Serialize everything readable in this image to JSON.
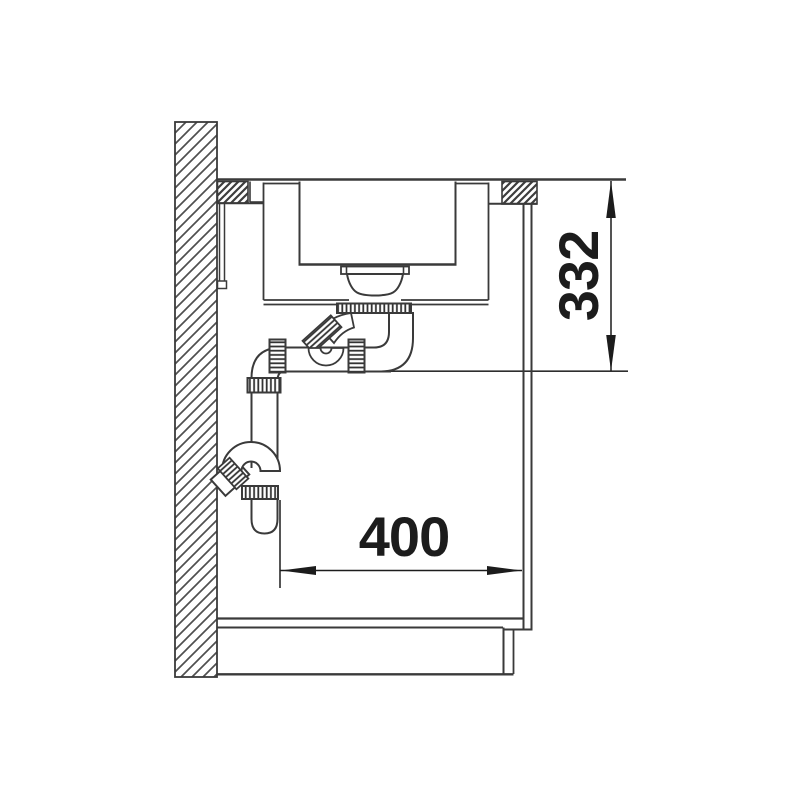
{
  "drawing": {
    "title": "sink-installation-side-section",
    "type": "technical-line-drawing",
    "dimensions": {
      "vertical": {
        "label": "332",
        "description": "height from worktop surface down to siphon outlet level"
      },
      "horizontal": {
        "label": "400",
        "description": "clearance from siphon pipe to cabinet side panel"
      }
    },
    "colors": {
      "line": "#3a3a3a",
      "hatch": "#4f4f4f",
      "dimension": "#1c1c1c",
      "background": "#ffffff"
    }
  }
}
